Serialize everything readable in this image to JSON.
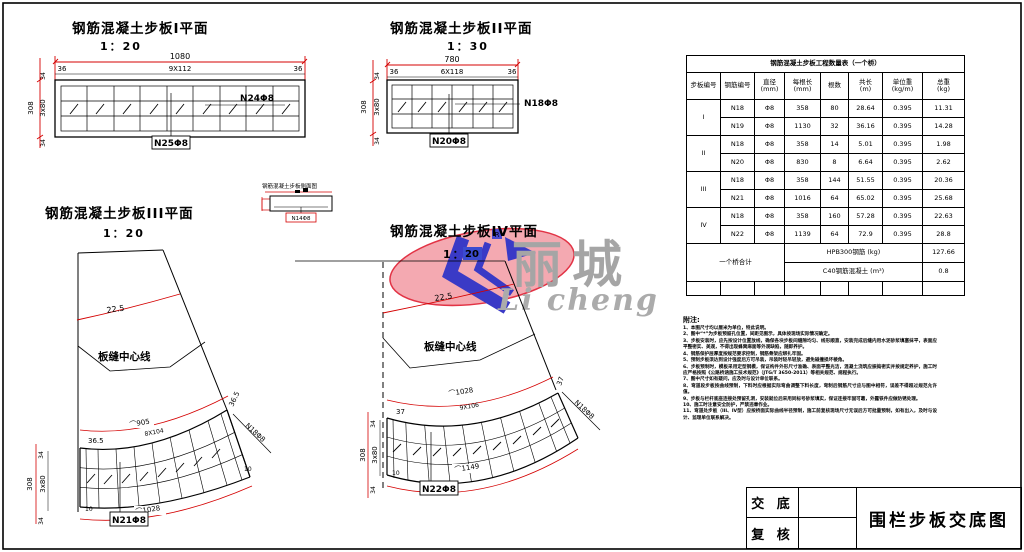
{
  "plan1": {
    "title": "钢筋混凝土步板I平面",
    "scale": "1：20",
    "dim_width": "1080",
    "dim_margin_left": "36",
    "dim_spacing": "9X112",
    "dim_margin_right": "36",
    "dim_height": "308",
    "dim_rows": "3x80",
    "dim_edge_top": "34",
    "dim_edge_bottom": "34",
    "label_right": "N24Φ8",
    "label_bottom": "N25Φ8"
  },
  "plan2": {
    "title": "钢筋混凝土步板II平面",
    "scale": "1：30",
    "dim_width": "780",
    "dim_margin_left": "36",
    "dim_spacing": "6X118",
    "dim_margin_right": "36",
    "dim_height": "308",
    "dim_rows": "3x80",
    "dim_edge_top": "34",
    "dim_edge_bottom": "34",
    "label_right": "N18Φ8",
    "label_bottom": "N20Φ8"
  },
  "plan3": {
    "title": "钢筋混凝土步板III平面",
    "scale": "1：20",
    "angle": "22.5",
    "seam_label": "板缝中心线",
    "arc_outer": "⌒905",
    "arc_inner": "⌒1028",
    "margin_left": "36.5",
    "margin_right": "36.5",
    "spacing": "8X104",
    "dim_height": "308",
    "dim_rows": "3x80",
    "dim_edge_top": "34",
    "dim_edge_bottom": "34",
    "edge_left": "10",
    "edge_right": "10",
    "label_bottom": "N21Φ8",
    "label_right": "N18Φ8"
  },
  "plan4": {
    "title": "钢筋混凝土步板IV平面",
    "scale_prefix": "1：",
    "scale_value": "20",
    "angle": "22.5",
    "seam_label": "板缝中心线",
    "arc_outer": "⌒1028",
    "arc_inner": "⌒1149",
    "margin_left": "37",
    "margin_right": "37",
    "spacing": "9X106",
    "dim_height": "308",
    "dim_rows": "3x80",
    "dim_edge_top": "34",
    "dim_edge_bottom": "34",
    "edge_left": "10",
    "label_bottom": "N22Φ8",
    "label_right": "N18Φ8"
  },
  "detail": {
    "title": "钢筋混凝土步板侧面图",
    "label": "N14Φ8"
  },
  "logo": {
    "name_cn": "丽城",
    "name_en": "Li cheng",
    "reg_mark": "R",
    "pink": "#f4a9b1",
    "blue": "#3a3ac6",
    "gray": "#a5a5a5"
  },
  "table": {
    "title": "钢筋混凝土步板工程数量表（一个桥）",
    "headers": [
      {
        "name": "步板编号",
        "unit": ""
      },
      {
        "name": "钢筋编号",
        "unit": ""
      },
      {
        "name": "直径",
        "unit": "(mm)"
      },
      {
        "name": "每根长",
        "unit": "(mm)"
      },
      {
        "name": "根数",
        "unit": ""
      },
      {
        "name": "共长",
        "unit": "(m)"
      },
      {
        "name": "单位重",
        "unit": "(kg/m)"
      },
      {
        "name": "总重",
        "unit": "(kg)"
      }
    ],
    "rows": [
      {
        "group": "I",
        "bar": "N18",
        "dia": "Φ8",
        "len": "358",
        "count": "80",
        "total_len": "28.64",
        "unit_wt": "0.395",
        "total_wt": "11.31"
      },
      {
        "bar": "N19",
        "dia": "Φ8",
        "len": "1130",
        "count": "32",
        "total_len": "36.16",
        "unit_wt": "0.395",
        "total_wt": "14.28"
      },
      {
        "group": "II",
        "bar": "N18",
        "dia": "Φ8",
        "len": "358",
        "count": "14",
        "total_len": "5.01",
        "unit_wt": "0.395",
        "total_wt": "1.98"
      },
      {
        "bar": "N20",
        "dia": "Φ8",
        "len": "830",
        "count": "8",
        "total_len": "6.64",
        "unit_wt": "0.395",
        "total_wt": "2.62"
      },
      {
        "group": "III",
        "bar": "N18",
        "dia": "Φ8",
        "len": "358",
        "count": "144",
        "total_len": "51.55",
        "unit_wt": "0.395",
        "total_wt": "20.36"
      },
      {
        "bar": "N21",
        "dia": "Φ8",
        "len": "1016",
        "count": "64",
        "total_len": "65.02",
        "unit_wt": "0.395",
        "total_wt": "25.68"
      },
      {
        "group": "IV",
        "bar": "N18",
        "dia": "Φ8",
        "len": "358",
        "count": "160",
        "total_len": "57.28",
        "unit_wt": "0.395",
        "total_wt": "22.63"
      },
      {
        "bar": "N22",
        "dia": "Φ8",
        "len": "1139",
        "count": "64",
        "total_len": "72.9",
        "unit_wt": "0.395",
        "total_wt": "28.8"
      }
    ],
    "summary_label": "一个桥合计",
    "summary_rows": [
      {
        "name": "HPB300钢筋 (kg)",
        "value": "127.66"
      },
      {
        "name": "C40钢筋混凝土 (m³)",
        "value": "0.8"
      }
    ]
  },
  "notes": {
    "heading": "附注:",
    "items": [
      "1、本图尺寸均以厘米为单位，特此说明。",
      "2、图中“*”为步板预留孔位置，间距见图示，具体按现场实际情况确定。",
      "3、步板安装时，应先按设计位置放线，确保各块步板间缝隙均匀、线形顺直，安装完成后缝内用水泥砂浆填塞抹平，表面应平整密实、美观，不得出现蜂窝麻面等外观缺陷，随即养护。",
      "4、钢筋保护层厚度按规范要求控制，钢筋骨架应绑扎牢固。",
      "5、预制步板须达到设计强度后方可吊装，吊装时轻吊轻放，避免碰撞损坏棱角。",
      "6、步板预制时，模板采用定型钢模，保证构件外形尺寸准确、表面平整光洁，混凝土浇筑应振捣密实并按规定养护，施工时应严格按照《公路桥涵施工技术规范》（JTG/T 3650-2011）等相关规范、规程执行。",
      "7、图中尺寸如有疑问，应及时与设计单位联系。",
      "8、弯道段步板按曲线预制，下料时应根据实际弯曲调整下料长度，弯制后钢筋尺寸应与图中相符，误差不得超过规范允许值。",
      "9、步板与栏杆底座连接处预留孔洞，安装就位后采用同标号砂浆填实，保证连接牢固可靠，外露铁件应做防锈处理。",
      "10、施工时注意安全防护，严禁违章作业。",
      "11、弯道处步板（III、IV型）应按桥面实际曲线半径预制，施工前复核现场尺寸无误后方可批量预制，如有出入，及时与设计、监理单位联系解决。"
    ]
  },
  "title_block": {
    "field1": "交 底",
    "field2": "复 核",
    "drawing_title": "围栏步板交底图"
  }
}
